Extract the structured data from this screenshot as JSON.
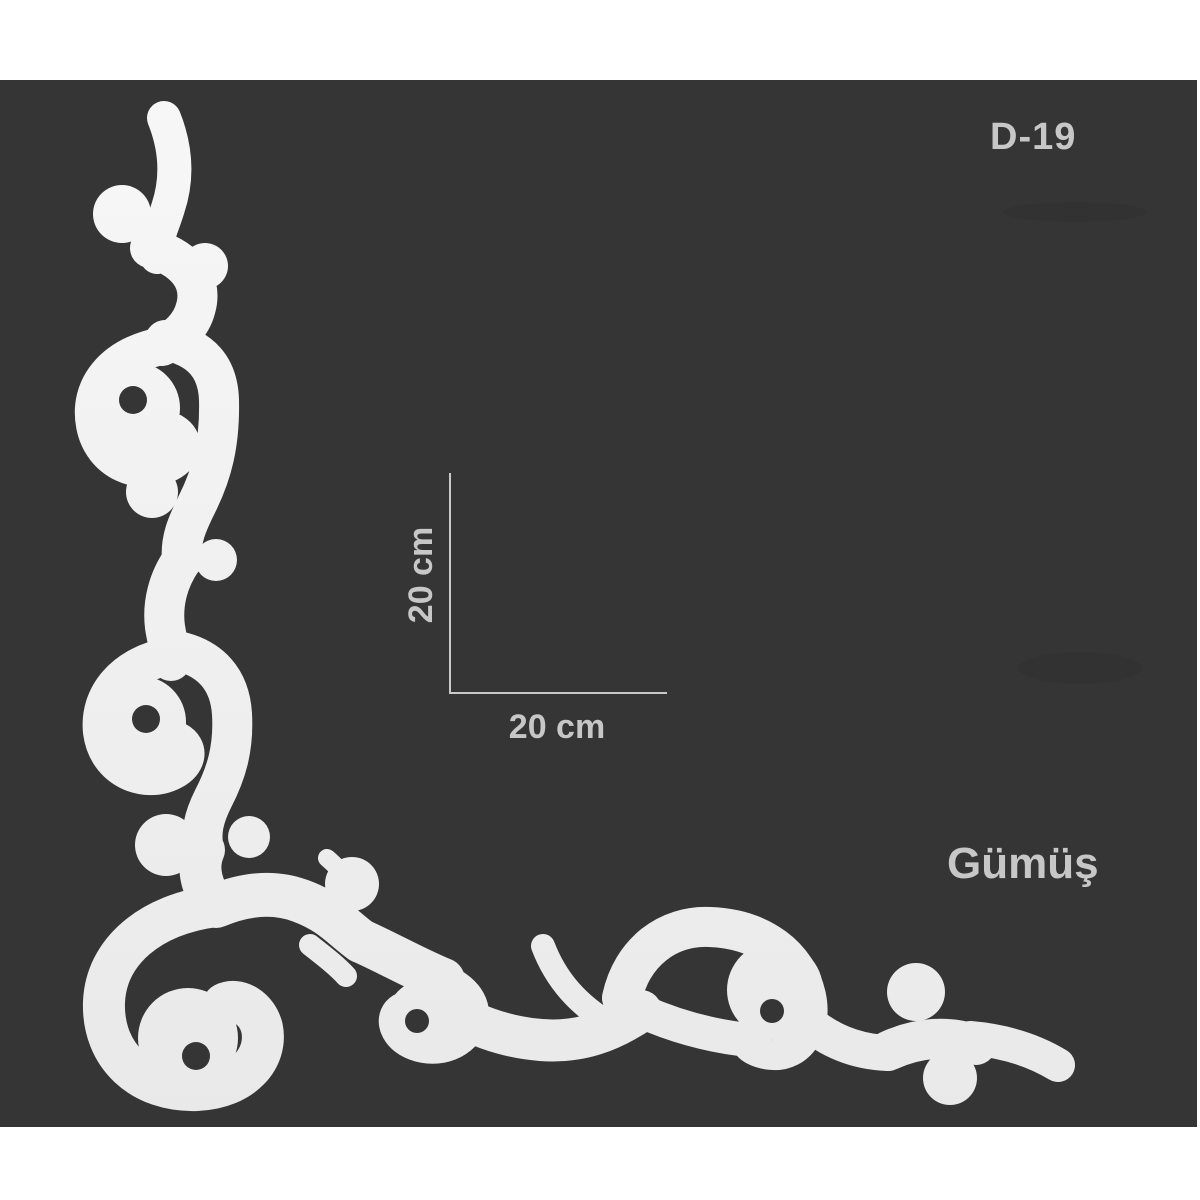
{
  "product": {
    "model_code": "D-19",
    "color_name": "Gümüş",
    "dimension_vertical": "20 cm",
    "dimension_horizontal": "20 cm"
  },
  "canvas": {
    "background": "#353535",
    "text_color": "#c7c7c7",
    "dimension_line_color": "#c9c9c9"
  },
  "ornament": {
    "description": "white baroque corner scroll moulding with five screw holes",
    "color_top": "#f7f7f7",
    "color_bottom": "#e9e9e9",
    "hole_color": "#353535",
    "hole_count": 5
  }
}
